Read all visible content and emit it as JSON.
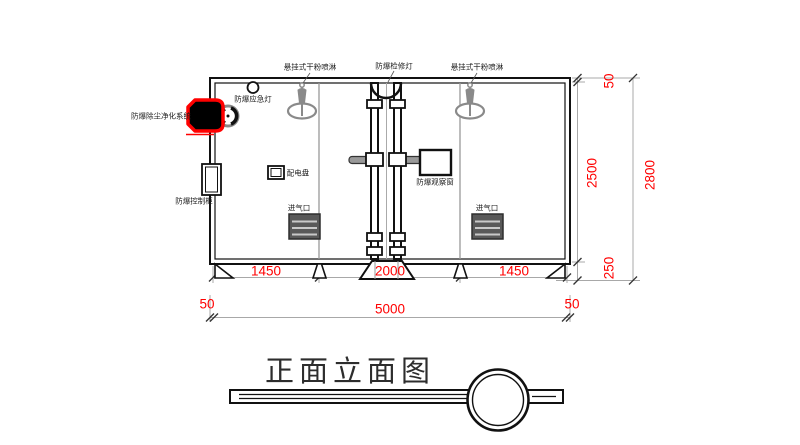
{
  "drawing_title": {
    "text": "正面立面图"
  },
  "equipment_labels": {
    "sprinkler_left": "悬挂式干粉喷淋",
    "inspection_lamp": "防爆检修灯",
    "sprinkler_right": "悬挂式干粉喷淋",
    "emergency_lamp": "防爆应急灯",
    "dust_purifier": "防爆除尘净化系统",
    "control_cabinet": "防爆控制柜",
    "distribution_panel": "配电盘",
    "observation_window": "防爆观察窗",
    "air_inlet_left": "进气口",
    "air_inlet_right": "进气口"
  },
  "dimensions": {
    "bottom_chain": [
      "1450",
      "2000",
      "1450"
    ],
    "bottom_total": "5000",
    "bottom_offset_left": "50",
    "bottom_offset_right": "50",
    "right_chain": {
      "top": "50",
      "body": "2500",
      "base": "250",
      "total": "2800"
    }
  },
  "colors": {
    "dimension_text": "#ff0000",
    "highlight_outline": "#ff0000",
    "linework": "#111111",
    "secondary_line": "#9b9b9b"
  }
}
